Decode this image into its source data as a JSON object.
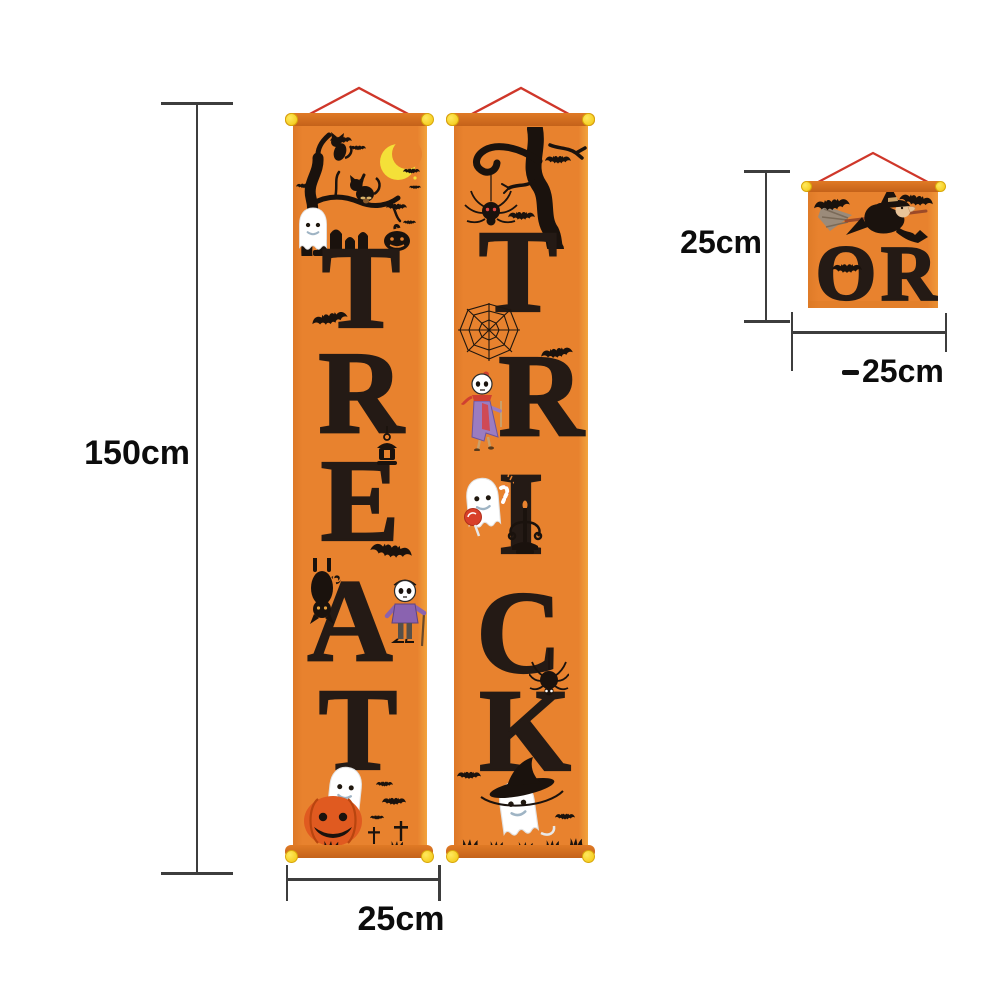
{
  "colors": {
    "background": "#ffffff",
    "banner_orange": "#e8822e",
    "rod_orange": "#cc6c1c",
    "cord_red": "#cf372a",
    "pin_yellow": "#f6cf16",
    "letter_color": "#241a15",
    "pumpkin_orange": "#e05a20",
    "moon_yellow": "#f4e038",
    "dimension_line": "#3d3d3d",
    "label_color": "#0c0c0c"
  },
  "dimensions": {
    "banner_height": "150cm",
    "banner_width": "25cm",
    "small_banner_height": "25cm",
    "small_banner_width": "25cm"
  },
  "banners": {
    "treat": {
      "letters": [
        "T",
        "R",
        "E",
        "A",
        "T"
      ],
      "decorations": [
        "spooky-tree-icon",
        "black-cat-icon",
        "crescent-moon-icon",
        "bat-icon",
        "ghost-icon",
        "black-pumpkin-icon",
        "tombstones-icon",
        "fly-icon",
        "hanging-lantern-icon",
        "hanging-cat-icon",
        "skeleton-kid-icon",
        "ghost-on-pumpkin-icon",
        "grave-cross-icon",
        "grass-icon"
      ]
    },
    "trick": {
      "letters": [
        "T",
        "R",
        "I",
        "C",
        "K"
      ],
      "decorations": [
        "dead-branch-icon",
        "hanging-spider-icon",
        "bat-icon",
        "spider-web-icon",
        "skeleton-witch-icon",
        "ghost-lollipop-icon",
        "candy-cane-icon",
        "candelabra-icon",
        "spider-icon",
        "witch-hat-ghost-icon",
        "grass-icon"
      ]
    },
    "or": {
      "letters": [
        "O",
        "R"
      ],
      "decorations": [
        "flying-witch-icon",
        "bat-icon",
        "bat-icon",
        "bat-icon"
      ]
    }
  }
}
